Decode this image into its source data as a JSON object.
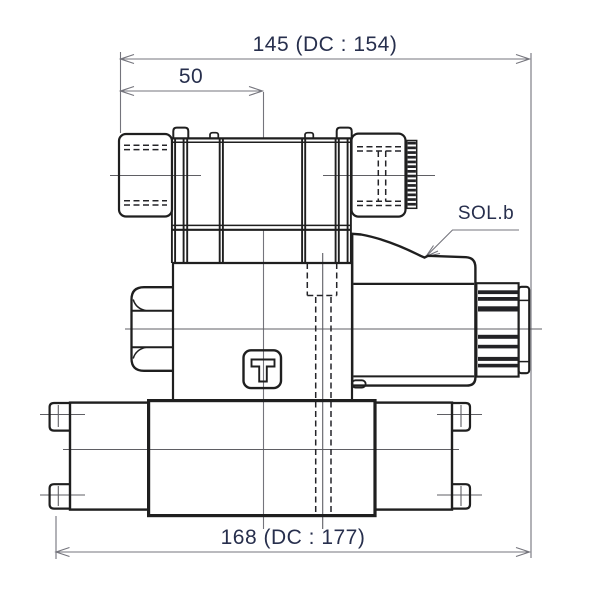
{
  "labels": {
    "dim_overall_top": "145 (DC : 154)",
    "dim_left_offset": "50",
    "dim_overall_bottom": "168 (DC : 177)",
    "solenoid_label": "SOL.b",
    "logo_letter": "T"
  },
  "colors": {
    "background": "#ffffff",
    "outline": "#1f1f1f",
    "thin_line": "#74747c",
    "hidden_line": "#242428",
    "dimension_text": "#272f4d"
  }
}
